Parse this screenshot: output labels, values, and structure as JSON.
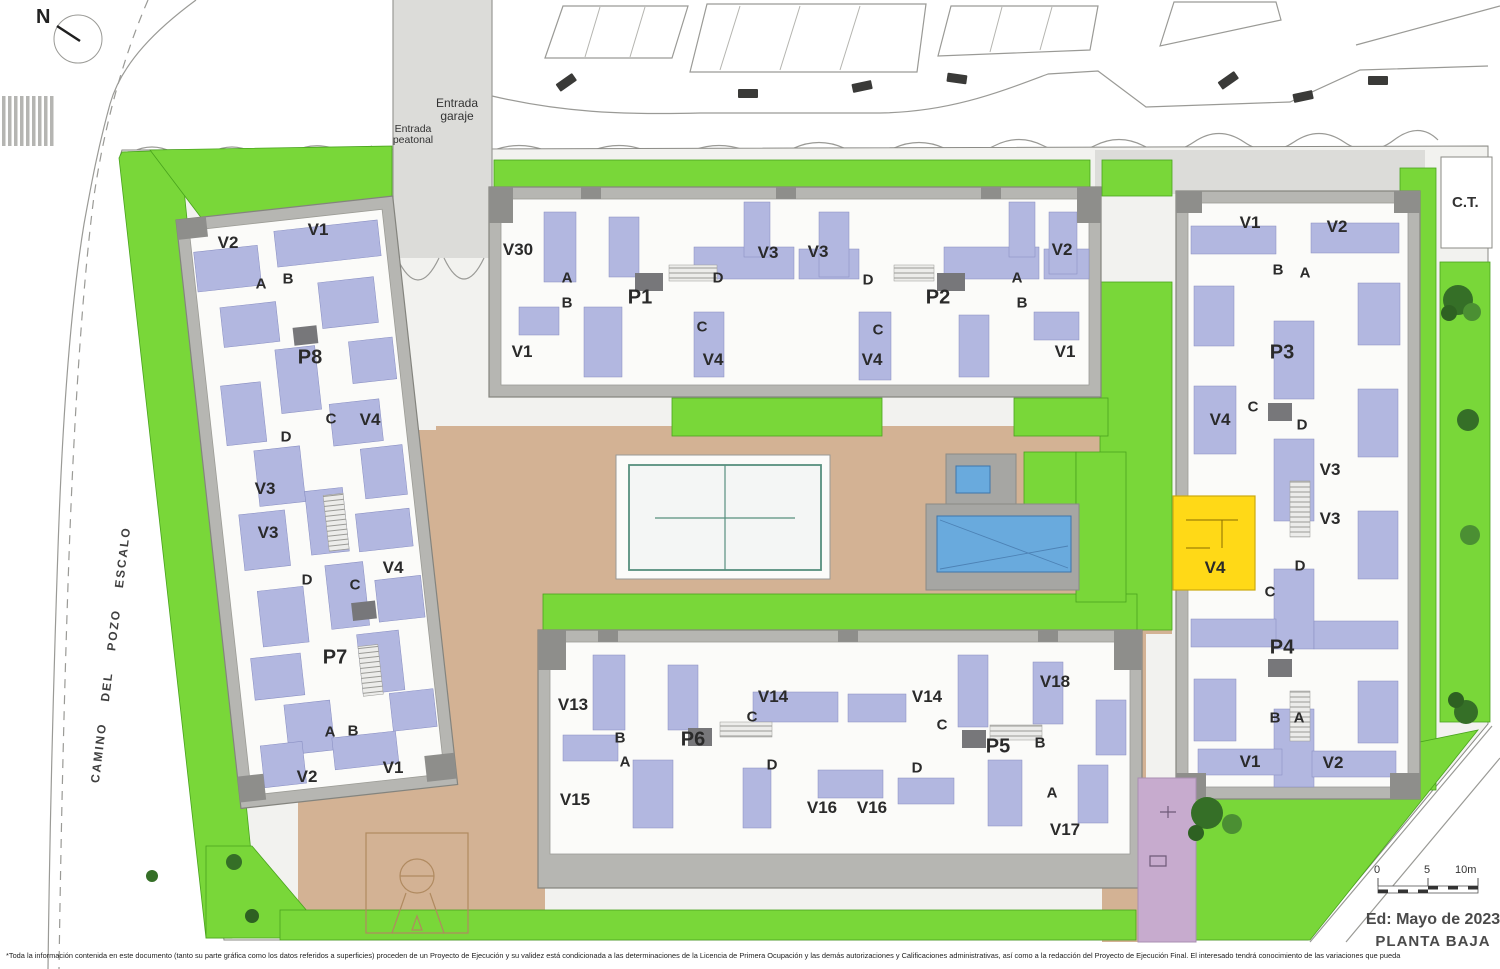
{
  "meta": {
    "floor_title": "PLANTA BAJA",
    "edition": "Ed: Mayo de 2023"
  },
  "north": {
    "label": "N"
  },
  "street": {
    "name": "CAMINO DEL POZO ESCALO"
  },
  "entrances": {
    "garage": [
      "Entrada",
      "garaje"
    ],
    "pedestrian": [
      "Entrada",
      "peatonal"
    ]
  },
  "ct": {
    "label": "C.T."
  },
  "scale_bar": {
    "ticks": [
      "0",
      "5",
      "10m"
    ]
  },
  "highlight": {
    "label": "V4",
    "color": "#ffd917"
  },
  "colors": {
    "green": "#79d739",
    "tan": "#d3b294",
    "building_gray": "#b6b6b2",
    "room_blue": "#b2b7e0",
    "pool_blue": "#69aadd",
    "playground_purple": "#c7abce",
    "highlight_yellow": "#ffd917"
  },
  "disclaimer": "*Toda la información contenida en este documento (tanto su parte gráfica como los datos referidos a superficies) proceden de un Proyecto de Ejecución y su validez está condicionada a las determinaciones de la Licencia de Primera Ocupación y las demás autorizaciones y Calificaciones administrativas, así como a la redacción del Proyecto de Ejecución Final. El interesado tendrá conocimiento de las variaciones que pueda",
  "unit_labels": [
    {
      "b": "west",
      "t": "V2",
      "x": 228,
      "y": 243,
      "k": "v"
    },
    {
      "b": "west",
      "t": "V1",
      "x": 318,
      "y": 230,
      "k": "v"
    },
    {
      "b": "west",
      "t": "A",
      "x": 261,
      "y": 284,
      "k": "l"
    },
    {
      "b": "west",
      "t": "B",
      "x": 288,
      "y": 279,
      "k": "l"
    },
    {
      "b": "west",
      "t": "P8",
      "x": 310,
      "y": 358,
      "k": "p"
    },
    {
      "b": "west",
      "t": "C",
      "x": 331,
      "y": 419,
      "k": "l"
    },
    {
      "b": "west",
      "t": "D",
      "x": 286,
      "y": 437,
      "k": "l"
    },
    {
      "b": "west",
      "t": "V4",
      "x": 370,
      "y": 420,
      "k": "v"
    },
    {
      "b": "west",
      "t": "V3",
      "x": 265,
      "y": 489,
      "k": "v"
    },
    {
      "b": "west",
      "t": "V3",
      "x": 268,
      "y": 533,
      "k": "v"
    },
    {
      "b": "west",
      "t": "D",
      "x": 307,
      "y": 580,
      "k": "l"
    },
    {
      "b": "west",
      "t": "C",
      "x": 355,
      "y": 585,
      "k": "l"
    },
    {
      "b": "west",
      "t": "V4",
      "x": 393,
      "y": 568,
      "k": "v"
    },
    {
      "b": "west",
      "t": "P7",
      "x": 335,
      "y": 658,
      "k": "p"
    },
    {
      "b": "west",
      "t": "A",
      "x": 330,
      "y": 732,
      "k": "l"
    },
    {
      "b": "west",
      "t": "B",
      "x": 353,
      "y": 731,
      "k": "l"
    },
    {
      "b": "west",
      "t": "V2",
      "x": 307,
      "y": 777,
      "k": "v"
    },
    {
      "b": "west",
      "t": "V1",
      "x": 393,
      "y": 768,
      "k": "v"
    },
    {
      "b": "mid",
      "t": "V30",
      "x": 518,
      "y": 250,
      "k": "v"
    },
    {
      "b": "mid",
      "t": "A",
      "x": 567,
      "y": 278,
      "k": "l"
    },
    {
      "b": "mid",
      "t": "B",
      "x": 567,
      "y": 303,
      "k": "l"
    },
    {
      "b": "mid",
      "t": "P1",
      "x": 640,
      "y": 298,
      "k": "p"
    },
    {
      "b": "mid",
      "t": "D",
      "x": 718,
      "y": 278,
      "k": "l"
    },
    {
      "b": "mid",
      "t": "C",
      "x": 702,
      "y": 327,
      "k": "l"
    },
    {
      "b": "mid",
      "t": "V3",
      "x": 768,
      "y": 253,
      "k": "v"
    },
    {
      "b": "mid",
      "t": "V1",
      "x": 522,
      "y": 352,
      "k": "v"
    },
    {
      "b": "mid",
      "t": "V4",
      "x": 713,
      "y": 360,
      "k": "v"
    },
    {
      "b": "mid",
      "t": "V3",
      "x": 818,
      "y": 252,
      "k": "v"
    },
    {
      "b": "mid",
      "t": "D",
      "x": 868,
      "y": 280,
      "k": "l"
    },
    {
      "b": "mid",
      "t": "P2",
      "x": 938,
      "y": 298,
      "k": "p"
    },
    {
      "b": "mid",
      "t": "A",
      "x": 1017,
      "y": 278,
      "k": "l"
    },
    {
      "b": "mid",
      "t": "B",
      "x": 1022,
      "y": 303,
      "k": "l"
    },
    {
      "b": "mid",
      "t": "C",
      "x": 878,
      "y": 330,
      "k": "l"
    },
    {
      "b": "mid",
      "t": "V4",
      "x": 872,
      "y": 360,
      "k": "v"
    },
    {
      "b": "mid",
      "t": "V2",
      "x": 1062,
      "y": 250,
      "k": "v"
    },
    {
      "b": "mid",
      "t": "V1",
      "x": 1065,
      "y": 352,
      "k": "v"
    },
    {
      "b": "right",
      "t": "V1",
      "x": 1250,
      "y": 223,
      "k": "v"
    },
    {
      "b": "right",
      "t": "V2",
      "x": 1337,
      "y": 227,
      "k": "v"
    },
    {
      "b": "right",
      "t": "B",
      "x": 1278,
      "y": 270,
      "k": "l"
    },
    {
      "b": "right",
      "t": "A",
      "x": 1305,
      "y": 273,
      "k": "l"
    },
    {
      "b": "right",
      "t": "P3",
      "x": 1282,
      "y": 353,
      "k": "p"
    },
    {
      "b": "right",
      "t": "C",
      "x": 1253,
      "y": 407,
      "k": "l"
    },
    {
      "b": "right",
      "t": "D",
      "x": 1302,
      "y": 425,
      "k": "l"
    },
    {
      "b": "right",
      "t": "V4",
      "x": 1220,
      "y": 420,
      "k": "v"
    },
    {
      "b": "right",
      "t": "V3",
      "x": 1330,
      "y": 470,
      "k": "v"
    },
    {
      "b": "right",
      "t": "V3",
      "x": 1330,
      "y": 519,
      "k": "v"
    },
    {
      "b": "right",
      "t": "V4",
      "x": 1215,
      "y": 568,
      "k": "v"
    },
    {
      "b": "right",
      "t": "D",
      "x": 1300,
      "y": 566,
      "k": "l"
    },
    {
      "b": "right",
      "t": "C",
      "x": 1270,
      "y": 592,
      "k": "l"
    },
    {
      "b": "right",
      "t": "P4",
      "x": 1282,
      "y": 648,
      "k": "p"
    },
    {
      "b": "right",
      "t": "B",
      "x": 1275,
      "y": 718,
      "k": "l"
    },
    {
      "b": "right",
      "t": "A",
      "x": 1299,
      "y": 718,
      "k": "l"
    },
    {
      "b": "right",
      "t": "V1",
      "x": 1250,
      "y": 762,
      "k": "v"
    },
    {
      "b": "right",
      "t": "V2",
      "x": 1333,
      "y": 763,
      "k": "v"
    },
    {
      "b": "bottom",
      "t": "V13",
      "x": 573,
      "y": 705,
      "k": "v"
    },
    {
      "b": "bottom",
      "t": "B",
      "x": 620,
      "y": 738,
      "k": "l"
    },
    {
      "b": "bottom",
      "t": "A",
      "x": 625,
      "y": 762,
      "k": "l"
    },
    {
      "b": "bottom",
      "t": "P6",
      "x": 693,
      "y": 740,
      "k": "p"
    },
    {
      "b": "bottom",
      "t": "C",
      "x": 752,
      "y": 717,
      "k": "l"
    },
    {
      "b": "bottom",
      "t": "V14",
      "x": 773,
      "y": 697,
      "k": "v"
    },
    {
      "b": "bottom",
      "t": "D",
      "x": 772,
      "y": 765,
      "k": "l"
    },
    {
      "b": "bottom",
      "t": "V15",
      "x": 575,
      "y": 800,
      "k": "v"
    },
    {
      "b": "bottom",
      "t": "V16",
      "x": 822,
      "y": 808,
      "k": "v"
    },
    {
      "b": "bottom",
      "t": "V16",
      "x": 872,
      "y": 808,
      "k": "v"
    },
    {
      "b": "bottom",
      "t": "V14",
      "x": 927,
      "y": 697,
      "k": "v"
    },
    {
      "b": "bottom",
      "t": "C",
      "x": 942,
      "y": 725,
      "k": "l"
    },
    {
      "b": "bottom",
      "t": "P5",
      "x": 998,
      "y": 747,
      "k": "p"
    },
    {
      "b": "bottom",
      "t": "B",
      "x": 1040,
      "y": 743,
      "k": "l"
    },
    {
      "b": "bottom",
      "t": "V18",
      "x": 1055,
      "y": 682,
      "k": "v"
    },
    {
      "b": "bottom",
      "t": "D",
      "x": 917,
      "y": 768,
      "k": "l"
    },
    {
      "b": "bottom",
      "t": "A",
      "x": 1052,
      "y": 793,
      "k": "l"
    },
    {
      "b": "bottom",
      "t": "V17",
      "x": 1065,
      "y": 830,
      "k": "v"
    }
  ]
}
